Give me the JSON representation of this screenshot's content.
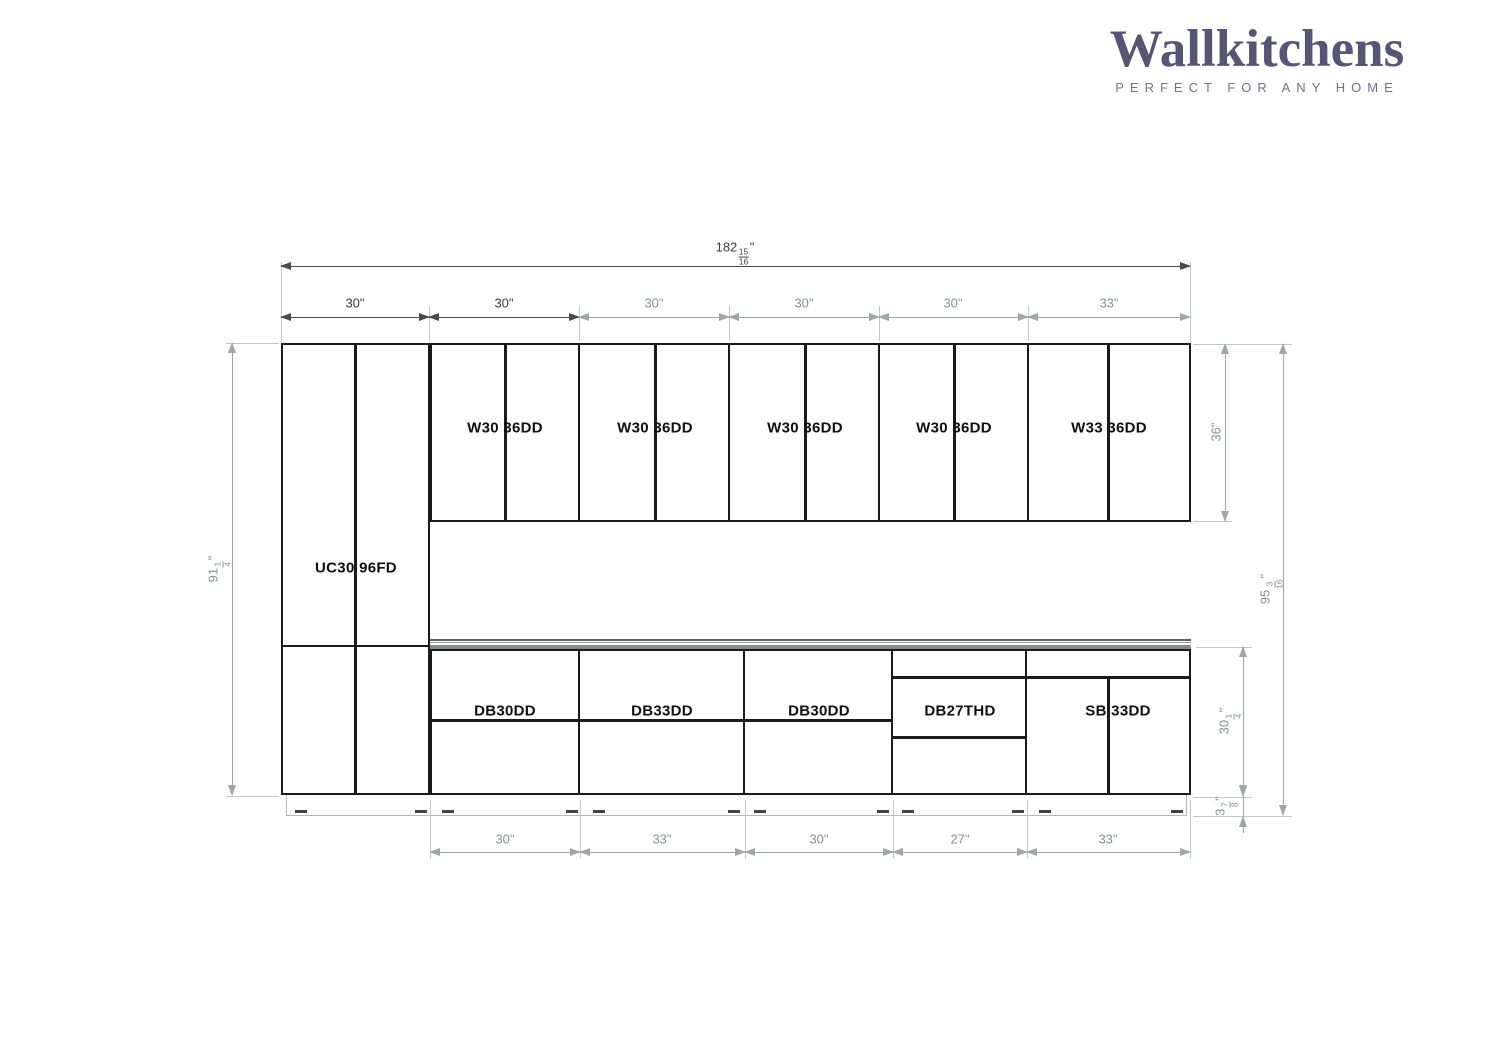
{
  "brand": {
    "name": "Wallkitchens",
    "tagline": "PERFECT FOR ANY HOME",
    "logo_color": "#565674"
  },
  "cabinets": {
    "tall": {
      "label": "UC30 96FD"
    },
    "wall": [
      {
        "label": "W30 36DD"
      },
      {
        "label": "W30 36DD"
      },
      {
        "label": "W30 36DD"
      },
      {
        "label": "W30 36DD"
      },
      {
        "label": "W33 36DD"
      }
    ],
    "base": [
      {
        "label": "DB30DD"
      },
      {
        "label": "DB33DD"
      },
      {
        "label": "DB30DD"
      },
      {
        "label": "DB27THD"
      },
      {
        "label": "SB 33DD"
      }
    ]
  },
  "dimensions": {
    "total_width": {
      "whole": "182",
      "num": "15",
      "den": "16",
      "unit": "\""
    },
    "row2": [
      {
        "whole": "30",
        "unit": "\""
      },
      {
        "whole": "30",
        "unit": "\""
      },
      {
        "whole": "30",
        "unit": "\""
      },
      {
        "whole": "30",
        "unit": "\""
      },
      {
        "whole": "30",
        "unit": "\""
      },
      {
        "whole": "33",
        "unit": "\""
      }
    ],
    "bottom_row": [
      {
        "whole": "30",
        "unit": "\""
      },
      {
        "whole": "33",
        "unit": "\""
      },
      {
        "whole": "30",
        "unit": "\""
      },
      {
        "whole": "27",
        "unit": "\""
      },
      {
        "whole": "33",
        "unit": "\""
      }
    ],
    "left_height": {
      "whole": "91",
      "num": "1",
      "den": "4",
      "unit": "\""
    },
    "wall_height": {
      "whole": "36",
      "unit": "\""
    },
    "total_height": {
      "whole": "95",
      "num": "3",
      "den": "16",
      "unit": "\""
    },
    "base_height": {
      "whole": "30",
      "num": "1",
      "den": "4",
      "unit": "\""
    },
    "toe_kick": {
      "whole": "3",
      "num": "7",
      "den": "8",
      "unit": "\""
    }
  },
  "colors": {
    "cabinet_line": "#1b1b1b",
    "dim_dark": "#4a4a4a",
    "dim_gray": "#a2a5a7",
    "countertop": "#87898b"
  }
}
